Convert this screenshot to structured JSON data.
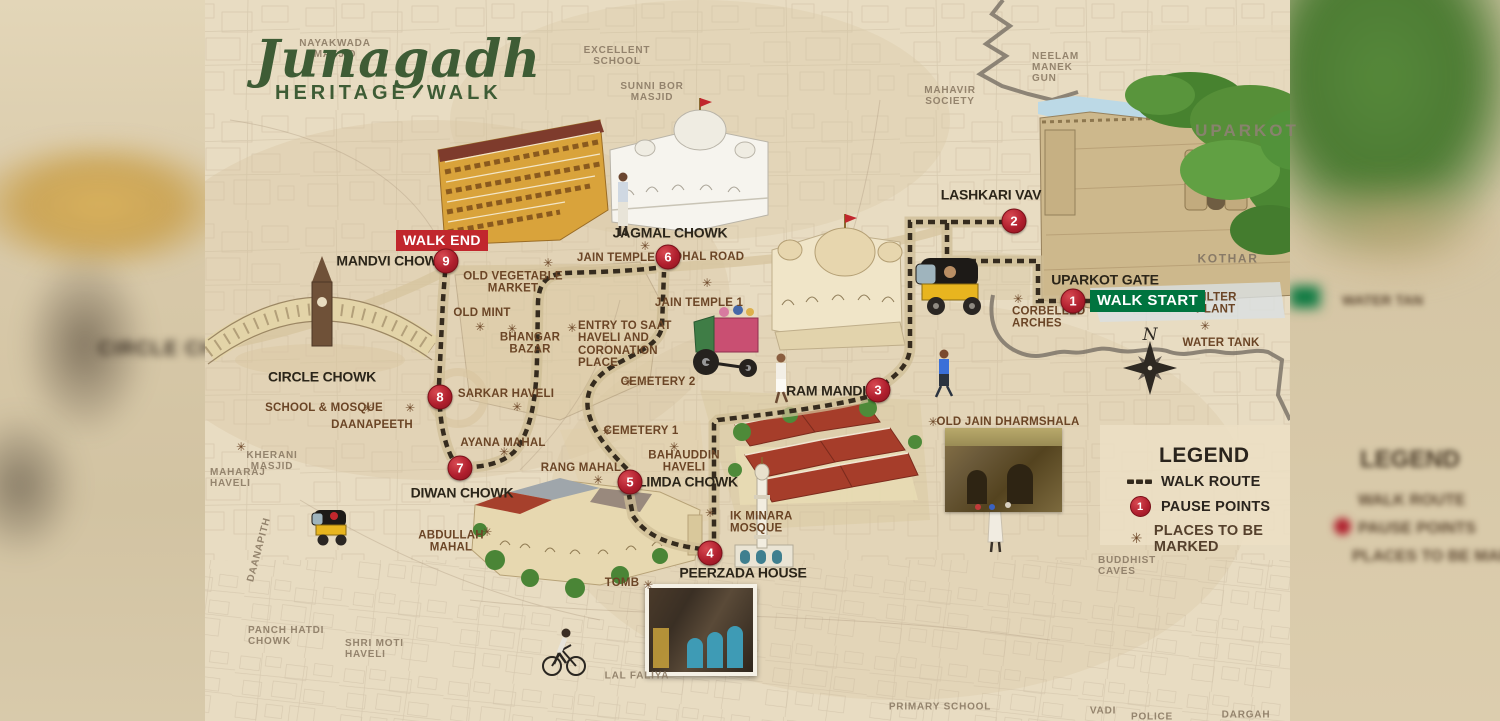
{
  "title": {
    "script": "Junagadh",
    "subtitle_left": "HERITAGE",
    "subtitle_right": "WALK"
  },
  "badges": {
    "walk_start": "WALK START",
    "walk_end": "WALK END"
  },
  "legend": {
    "title": "LEGEND",
    "items": [
      {
        "label": "WALK ROUTE"
      },
      {
        "label": "PAUSE POINTS",
        "symbol_number": "1"
      },
      {
        "label": "PLACES TO BE MARKED"
      }
    ]
  },
  "symbols": {
    "star": "✳"
  },
  "compass": {
    "n": "N"
  },
  "pause_points": [
    {
      "n": "1",
      "x": 1073,
      "y": 301
    },
    {
      "n": "2",
      "x": 1014,
      "y": 221
    },
    {
      "n": "3",
      "x": 878,
      "y": 390
    },
    {
      "n": "4",
      "x": 710,
      "y": 553
    },
    {
      "n": "5",
      "x": 630,
      "y": 482
    },
    {
      "n": "6",
      "x": 668,
      "y": 257
    },
    {
      "n": "7",
      "x": 460,
      "y": 468
    },
    {
      "n": "8",
      "x": 440,
      "y": 397
    },
    {
      "n": "9",
      "x": 446,
      "y": 261
    }
  ],
  "major_labels": [
    {
      "text": "JAGMAL CHOWK",
      "x": 670,
      "y": 233
    },
    {
      "text": "MANDVI CHOWK",
      "x": 392,
      "y": 261
    },
    {
      "text": "CIRCLE CHOWK",
      "x": 322,
      "y": 377
    },
    {
      "text": "DIWAN CHOWK",
      "x": 462,
      "y": 493
    },
    {
      "text": "LIMDA CHOWK",
      "x": 688,
      "y": 482
    },
    {
      "text": "RAM MANDIR",
      "x": 831,
      "y": 391
    },
    {
      "text": "UPARKOT GATE",
      "x": 1105,
      "y": 280
    },
    {
      "text": "LASHKARI VAV",
      "x": 991,
      "y": 195
    },
    {
      "text": "PEERZADA HOUSE",
      "x": 743,
      "y": 573
    }
  ],
  "minor_labels": [
    {
      "text": "OLD VEGETABLE\nMARKET",
      "x": 513,
      "y": 283
    },
    {
      "text": "OLD MINT",
      "x": 482,
      "y": 313
    },
    {
      "text": "BHANGAR\nBAZAR",
      "x": 530,
      "y": 344
    },
    {
      "text": "JAIN TEMPLE 2",
      "x": 621,
      "y": 258
    },
    {
      "text": "DHAL ROAD",
      "x": 709,
      "y": 257
    },
    {
      "text": "JAIN TEMPLE 1",
      "x": 699,
      "y": 303
    },
    {
      "text": "ENTRY TO SAAT\nHAVELI AND\nCORONATION\nPLACE",
      "x": 578,
      "y": 345,
      "cls": "al"
    },
    {
      "text": "CEMETERY 2",
      "x": 658,
      "y": 382
    },
    {
      "text": "CEMETERY 1",
      "x": 641,
      "y": 431
    },
    {
      "text": "BAHAUDDIN\nHAVELI",
      "x": 684,
      "y": 462
    },
    {
      "text": "RANG MAHAL",
      "x": 581,
      "y": 468
    },
    {
      "text": "SCHOOL & MOSQUE",
      "x": 324,
      "y": 408
    },
    {
      "text": "DAANAPEETH",
      "x": 372,
      "y": 425
    },
    {
      "text": "SARKAR HAVELI",
      "x": 506,
      "y": 394
    },
    {
      "text": "AYANA MAHAL",
      "x": 503,
      "y": 443
    },
    {
      "text": "ABDULLAH\nMAHAL",
      "x": 451,
      "y": 542
    },
    {
      "text": "TOMB",
      "x": 622,
      "y": 583
    },
    {
      "text": "IK MINARA\nMOSQUE",
      "x": 730,
      "y": 523,
      "cls": "al"
    },
    {
      "text": "OLD JAIN DHARMSHALA",
      "x": 1008,
      "y": 422
    },
    {
      "text": "CORBELLED\nARCHES",
      "x": 1012,
      "y": 318,
      "cls": "al"
    },
    {
      "text": "FILTER\nPLANT",
      "x": 1196,
      "y": 304,
      "cls": "al"
    },
    {
      "text": "WATER TANK",
      "x": 1221,
      "y": 343
    }
  ],
  "base_labels": [
    {
      "text": "NAYAKWADA\nMASJID",
      "x": 335,
      "y": 50
    },
    {
      "text": "EXCELLENT\nSCHOOL",
      "x": 617,
      "y": 57
    },
    {
      "text": "SUNNI BOR\nMASJID",
      "x": 652,
      "y": 93
    },
    {
      "text": "MAHAVIR\nSOCIETY",
      "x": 950,
      "y": 97
    },
    {
      "text": "NEELAM\nMANEK\nGUN",
      "x": 1032,
      "y": 68,
      "cls": "al"
    },
    {
      "text": "UPARKOT",
      "x": 1247,
      "y": 131,
      "cls": "xl"
    },
    {
      "text": "KOTHAR",
      "x": 1228,
      "y": 259,
      "cls": "lg"
    },
    {
      "text": "MAHARAJ\nHAVELI",
      "x": 210,
      "y": 479,
      "cls": "al"
    },
    {
      "text": "KHERANI\nMASJID",
      "x": 272,
      "y": 462
    },
    {
      "text": "DAANAPITH",
      "x": 260,
      "y": 550,
      "cls": "vert"
    },
    {
      "text": "PANCH HATDI\nCHOWK",
      "x": 248,
      "y": 637,
      "cls": "al"
    },
    {
      "text": "SHRI MOTI\nHAVELI",
      "x": 345,
      "y": 650,
      "cls": "al"
    },
    {
      "text": "LAL FALIYA",
      "x": 637,
      "y": 677
    },
    {
      "text": "PRIMARY SCHOOL",
      "x": 940,
      "y": 708
    },
    {
      "text": "VADI",
      "x": 1103,
      "y": 712
    },
    {
      "text": "POLICE",
      "x": 1152,
      "y": 718
    },
    {
      "text": "DARGAH",
      "x": 1246,
      "y": 716
    },
    {
      "text": "BUDDHIST\nCAVES",
      "x": 1098,
      "y": 567,
      "cls": "al"
    }
  ],
  "stars": [
    {
      "x": 548,
      "y": 263
    },
    {
      "x": 480,
      "y": 327
    },
    {
      "x": 512,
      "y": 329
    },
    {
      "x": 645,
      "y": 246
    },
    {
      "x": 707,
      "y": 283
    },
    {
      "x": 572,
      "y": 328
    },
    {
      "x": 628,
      "y": 382
    },
    {
      "x": 607,
      "y": 431
    },
    {
      "x": 674,
      "y": 447
    },
    {
      "x": 598,
      "y": 480
    },
    {
      "x": 368,
      "y": 408
    },
    {
      "x": 410,
      "y": 408
    },
    {
      "x": 517,
      "y": 407
    },
    {
      "x": 504,
      "y": 452
    },
    {
      "x": 487,
      "y": 532
    },
    {
      "x": 648,
      "y": 585
    },
    {
      "x": 933,
      "y": 422
    },
    {
      "x": 1018,
      "y": 299
    },
    {
      "x": 1205,
      "y": 326
    },
    {
      "x": 241,
      "y": 447
    },
    {
      "x": 710,
      "y": 513
    }
  ],
  "blur_left": {
    "circle_chowk": "CIRCLE CH"
  },
  "blur_right": {
    "water_tank": "WATER TAN",
    "legend_title": "LEGEND",
    "walk_route": "WALK ROUTE",
    "pause_points": "PAUSE POINTS",
    "places": "PLACES TO BE MARKED"
  },
  "colors": {
    "accent_red": "#b01f2e",
    "accent_green": "#00743f",
    "route": "#352b1e",
    "paper": "#e9ddc3",
    "minor_brown": "#6b4526",
    "major_dark": "#2b2519"
  }
}
